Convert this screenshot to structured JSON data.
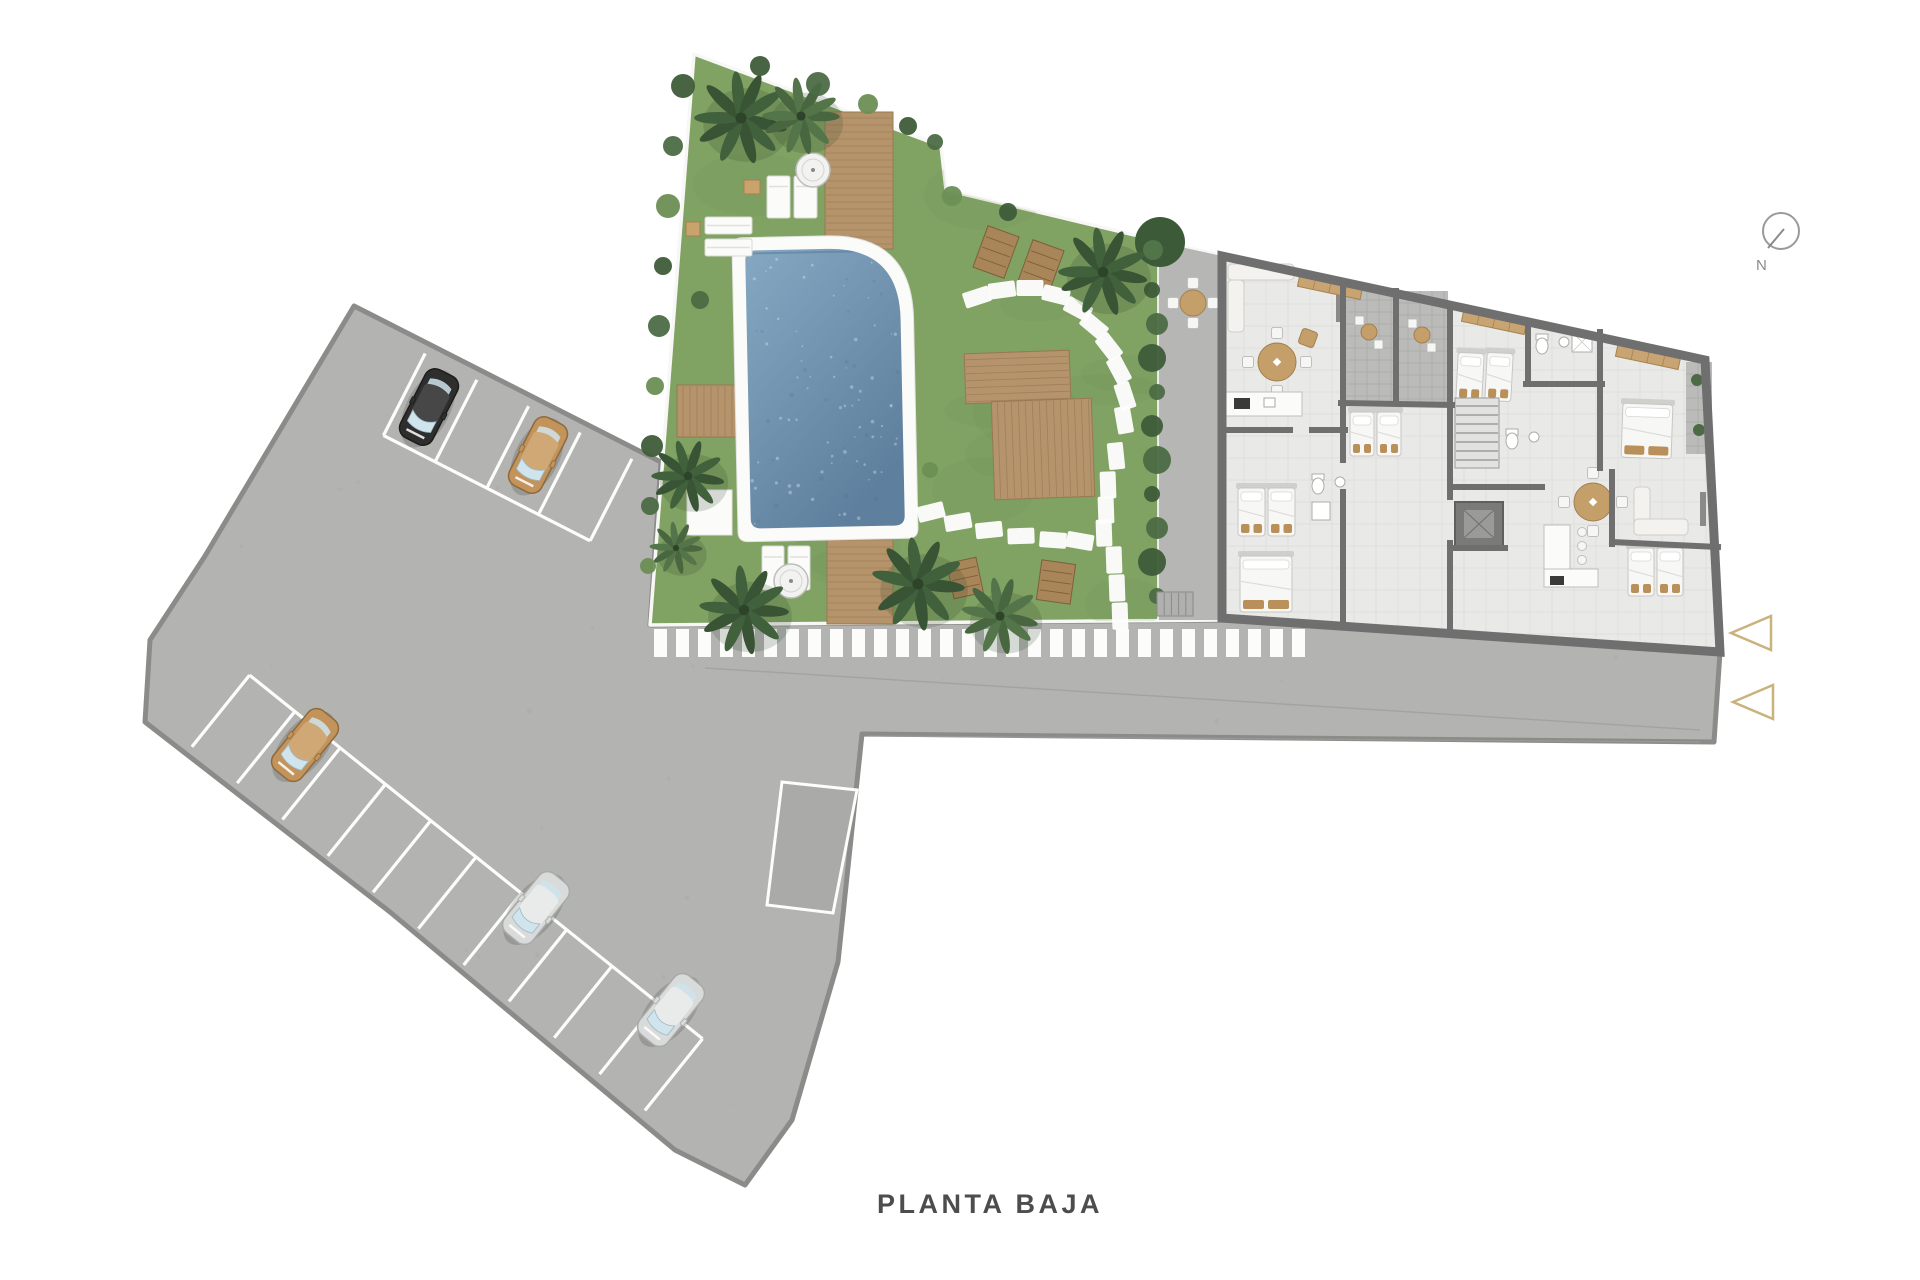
{
  "title": {
    "label": "PLANTA BAJA"
  },
  "compass": {
    "label": "N"
  },
  "palette": {
    "background": "#ffffff",
    "asphalt": "#b3b3b1",
    "asphalt_edge": "#8b8b89",
    "line_white": "#fdfdfc",
    "grass": "#80a263",
    "grass_shade": "#6d9154",
    "pool_water_light": "#85a8c2",
    "pool_water_dark": "#5e7f9d",
    "pool_curb": "#fbfbfa",
    "wood": "#b5936b",
    "wood_dark": "#977952",
    "wall": "#6f6f6f",
    "floor": "#e9e9e7",
    "floor_grid": "#d9d9d7",
    "terrace": "#bbbbb9",
    "patio": "#b6b6b4",
    "furniture_tan": "#c59f6a",
    "pillow_tan": "#b9905a",
    "bed_white": "#f7f7f5",
    "palm_dark": "#41603c",
    "palm_light": "#537549",
    "bush_green": "#4c6b45",
    "entrance_arrow": "#c9b27c",
    "title_text": "#4d4d4d",
    "compass_gray": "#9a9a9a"
  },
  "cars": [
    {
      "name": "black-car",
      "body": "#2e2e2e",
      "roof": "#474747",
      "outline": "#1d1d1d",
      "x": 429,
      "y": 407,
      "rot": 27
    },
    {
      "name": "tan-car-top",
      "body": "#c2945c",
      "roof": "#d0a876",
      "outline": "#8f6a3c",
      "x": 538,
      "y": 455,
      "rot": 27
    },
    {
      "name": "tan-car-left",
      "body": "#c2945c",
      "roof": "#d0a876",
      "outline": "#8f6a3c",
      "x": 305,
      "y": 745,
      "rot": 39
    },
    {
      "name": "silver-car-1",
      "body": "#d8dbda",
      "roof": "#e9ebea",
      "outline": "#a8abaa",
      "x": 536,
      "y": 908,
      "rot": 39
    },
    {
      "name": "silver-car-2",
      "body": "#d8dbda",
      "roof": "#e9ebea",
      "outline": "#a8abaa",
      "x": 671,
      "y": 1010,
      "rot": 39
    }
  ]
}
